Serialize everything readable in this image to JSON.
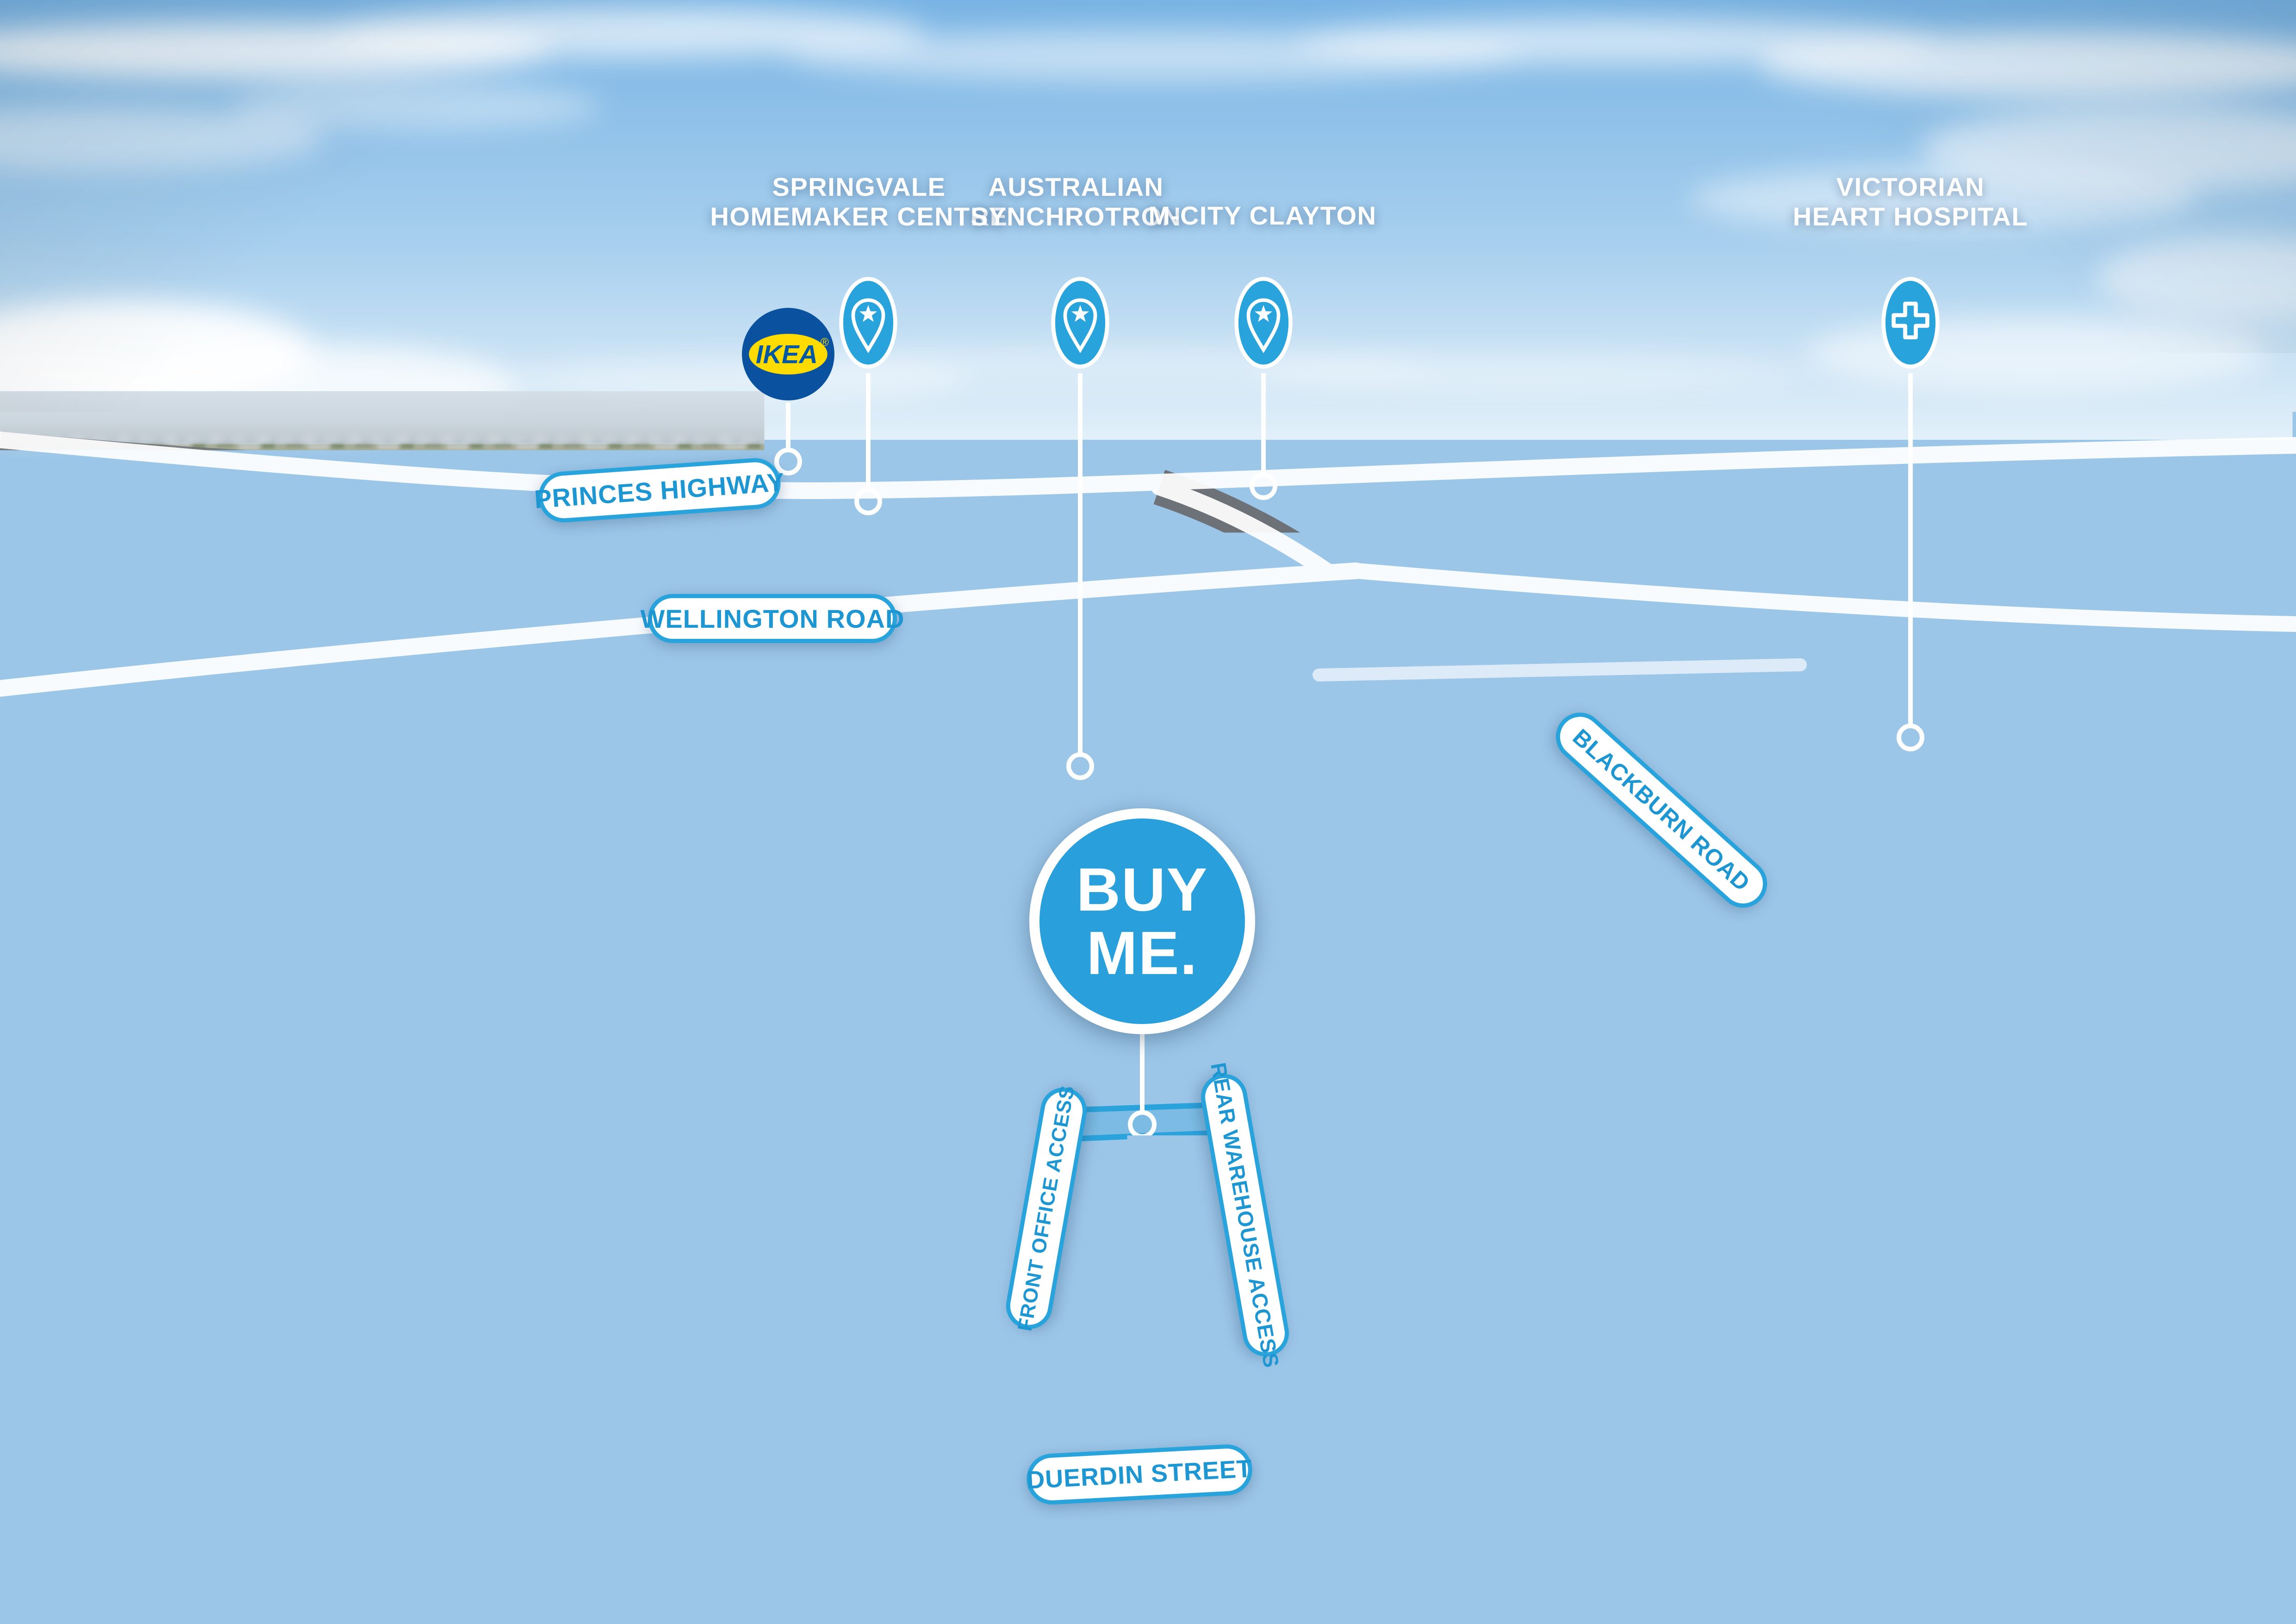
{
  "markers": {
    "springvale": {
      "line1": "SPRINGVALE",
      "line2": "HOMEMAKER CENTRE",
      "icon": "star-pin-icon"
    },
    "synchrotron": {
      "line1": "AUSTRALIAN",
      "line2": "SYNCHROTRON",
      "icon": "star-pin-icon"
    },
    "mcity": {
      "line1": "M-CITY CLAYTON",
      "icon": "star-pin-icon"
    },
    "hospital": {
      "line1": "VICTORIAN",
      "line2": "HEART HOSPITAL",
      "icon": "medical-cross-pin-icon"
    }
  },
  "road_labels": {
    "princes": "PRINCES HIGHWAY",
    "wellington": "WELLINGTON ROAD",
    "blackburn": "BLACKBURN ROAD",
    "duerdin": "DUERDIN STREET"
  },
  "access_labels": {
    "front": "FRONT OFFICE ACCESS",
    "rear": "REAR WAREHOUSE ACCESS"
  },
  "cta": {
    "line1": "BUY",
    "line2": "ME."
  },
  "brand_marks": {
    "ikea_badge": "IKEA",
    "ikea_reg": "®",
    "ikea_store_sign": "IKEA",
    "kent_wall_sign": "KENT",
    "kent_container_sign": "KENT",
    "aston_watermark": "ASTON",
    "aston_tm": "™"
  },
  "colors": {
    "accent_blue": "#29A3DC",
    "pill_text_blue": "#1E96D2",
    "buyme_blue": "#29A0DB",
    "ikea_blue": "#0058A3",
    "ikea_yellow": "#FFDB00",
    "overlay_white": "#FFFFFF"
  }
}
